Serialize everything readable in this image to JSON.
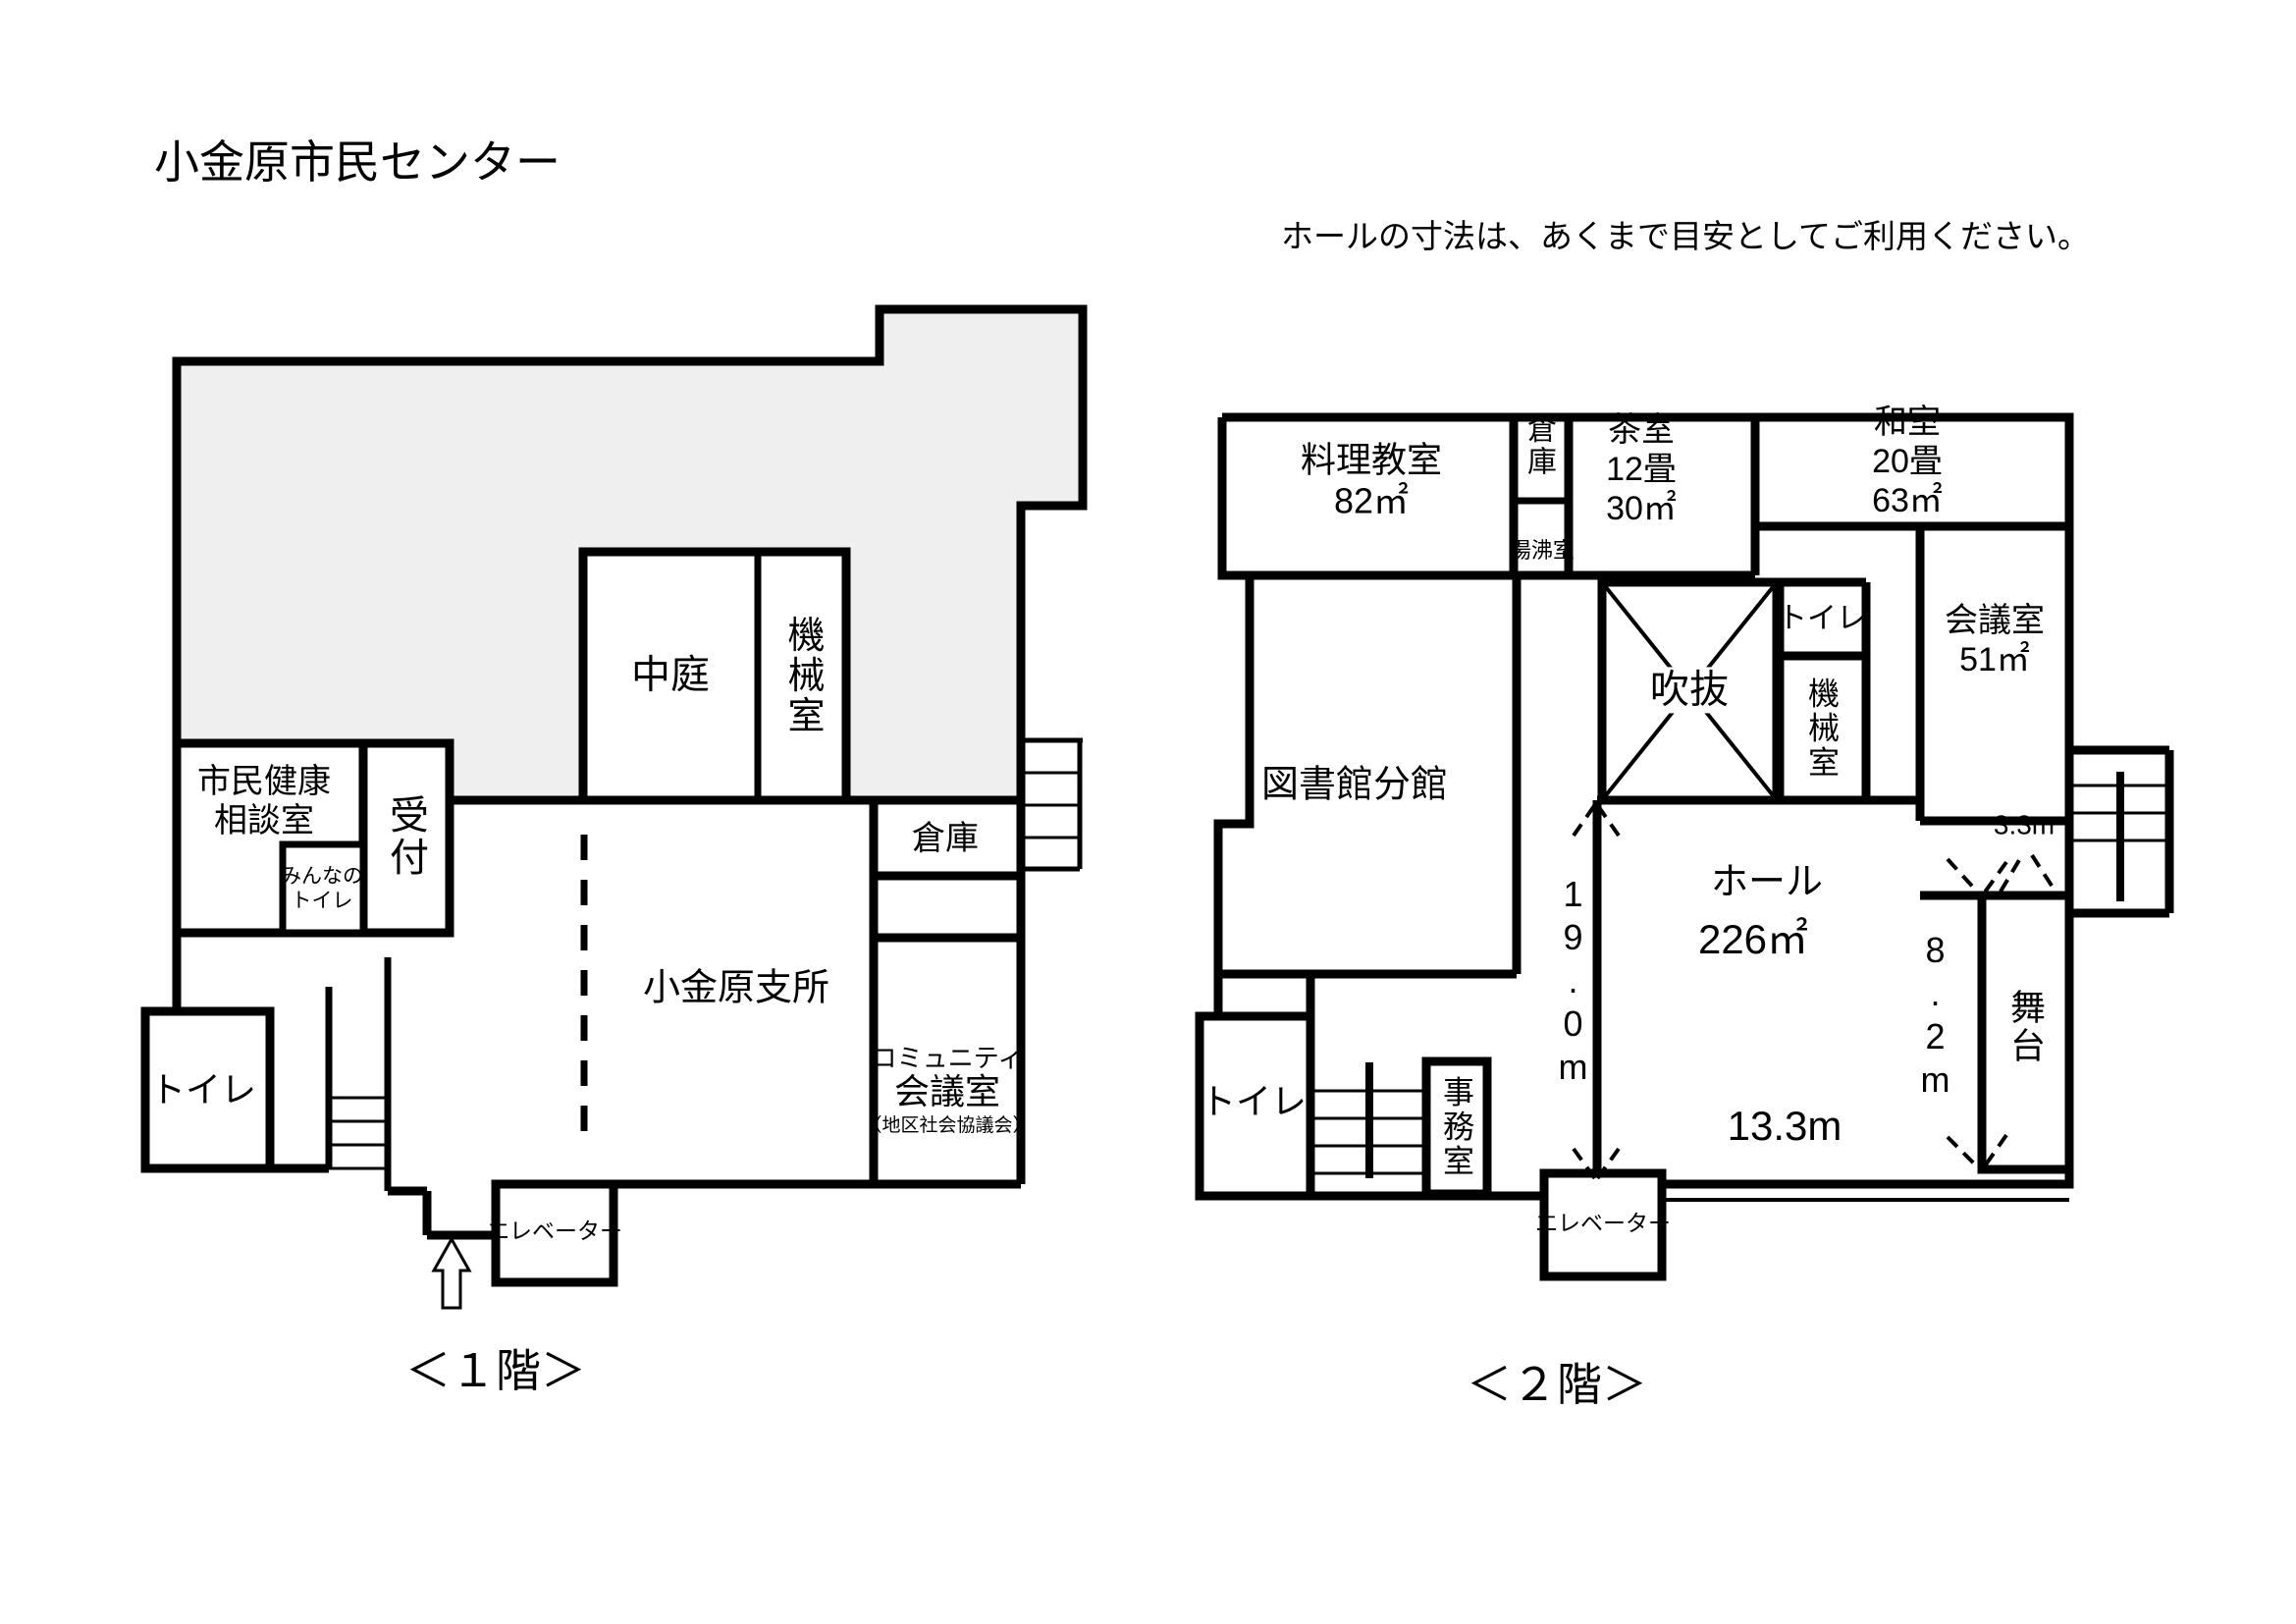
{
  "page": {
    "title": "小金原市民センター",
    "note": "ホールの寸法は、あくまで目安としてご利用ください。"
  },
  "floor1": {
    "caption": "＜１階＞",
    "labels": {
      "courtyard": "中庭",
      "machine_room": "機械室",
      "health_room": "市民健康\n相談室",
      "reception": "受付",
      "everyone_toilet": "みんなの\nトイレ",
      "toilet": "トイレ",
      "storage": "倉庫",
      "community_line1": "コミュニティ",
      "community_line2": "会議室",
      "community_line3": "（地区社会協議会）",
      "branch_office": "小金原支所",
      "elevator": "エレベーター"
    }
  },
  "floor2": {
    "caption": "＜２階＞",
    "labels": {
      "cooking_room": "料理教室\n82㎡",
      "storage": "倉庫",
      "kettle_room": "湯沸室",
      "tea_room": "茶室\n12畳\n30㎡",
      "japanese_room": "和室\n20畳\n63㎡",
      "meeting_room": "会議室\n51㎡",
      "toilet_upper": "トイレ",
      "machine_room": "機械室",
      "atrium": "吹抜",
      "library_branch": "図書館分館",
      "hall": "ホール",
      "hall_area": "226㎡",
      "hall_width": "13.3m",
      "hall_depth": "19.0m",
      "stage_depth": "8.2m",
      "stage_width": "3.3m",
      "stage": "舞台",
      "toilet_lower": "トイレ",
      "office": "事務室",
      "elevator": "エレベーター"
    }
  },
  "colors": {
    "wall": "#000000",
    "shaded_area": "#efefef"
  }
}
